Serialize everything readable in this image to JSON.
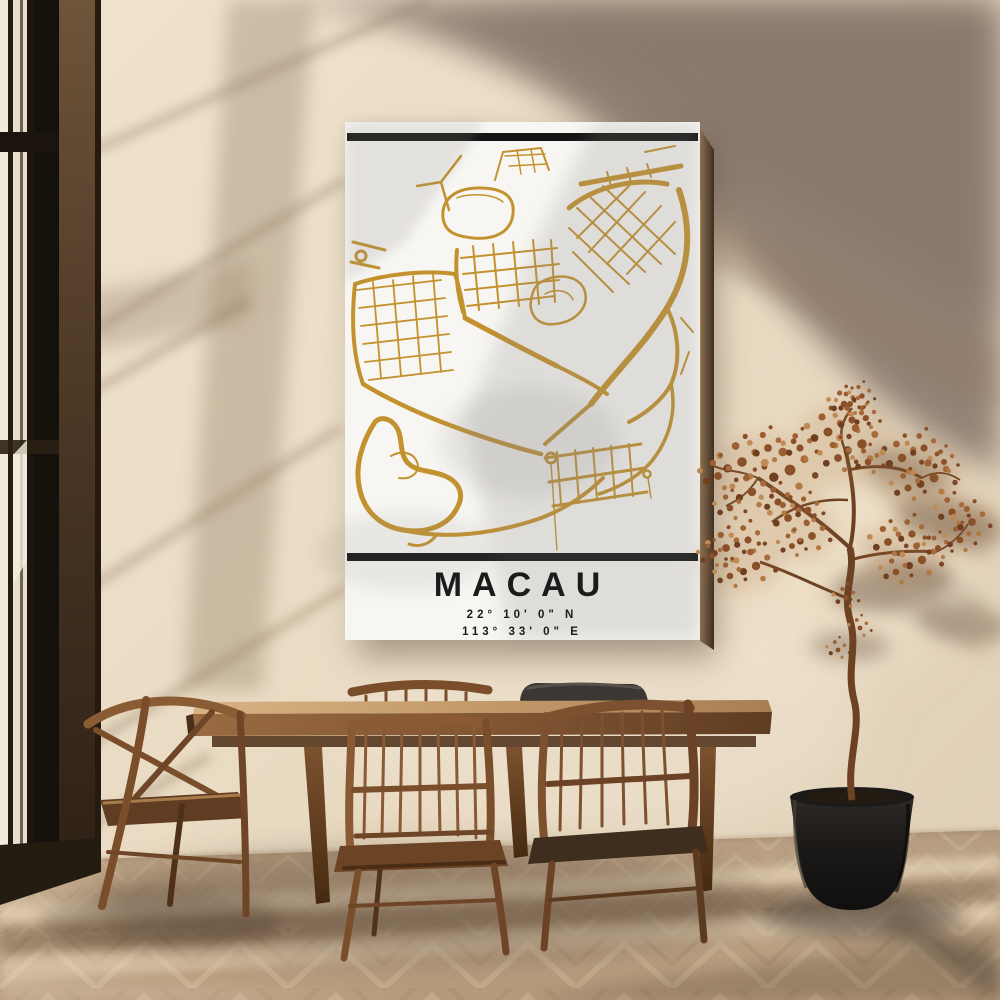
{
  "poster": {
    "title": "MACAU",
    "latitude": "22° 10' 0\" N",
    "longitude": "113° 33' 0\" E",
    "map_gold": "#C3922E",
    "bar_color": "#141414",
    "canvas_white": "#F8F6F2",
    "text_color": "#1B1B1B"
  },
  "palette": {
    "wall_light": "#EBDCC5",
    "wall_shadow": "#8C7A6B",
    "floor_wood": "#C3AA8D",
    "furniture_wood": "#8A5C36",
    "plant_foliage": "#9A6136",
    "pot_black": "#1A1817"
  }
}
